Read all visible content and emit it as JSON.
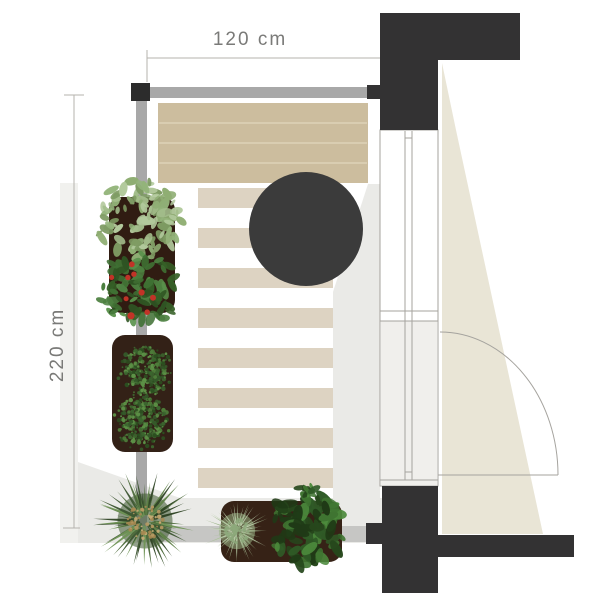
{
  "title": "Balcony floor plan, top view",
  "dimensions": {
    "width_label": "120 cm",
    "height_label": "220 cm"
  },
  "plan_items": [
    "wood-bench",
    "bistro-table",
    "striped-runner-rug",
    "balcony-railing",
    "tall-planter-with-leafy-herb",
    "tall-planter-with-strawberries",
    "planter-with-two-box-shrubs",
    "round-palm-plant",
    "trough-planter-with-fern-and-shrub",
    "glazed-balcony-door",
    "door-swing-arc",
    "wall-sections"
  ],
  "palette": {
    "wall": "#333233",
    "railing": "#a8a8a8",
    "railing_light": "#c6c6c4",
    "post": "#2c2c2c",
    "bench": "#ccbd9e",
    "bench_line": "#d9cdb1",
    "rug_base": "#ffffff",
    "rug_stripe": "#ddd3c2",
    "table": "#3b3b3b",
    "planter": "#33201575",
    "planter_solid": "#332015",
    "shade": "#eaeae7",
    "shade_soft": "#f1f1ee",
    "door_shade": "#e9e5d6",
    "line": "#b5b3ae",
    "frame_line": "#a5a39e",
    "door_lower": "#f0efec",
    "dim_text": "#7a7a78",
    "berry": "#c13327",
    "foliage": {
      "leafLight": [
        "#a3bd8b",
        "#8fae73",
        "#b2c99c",
        "#7d9a62",
        "#93b47a"
      ],
      "leafMid": [
        "#3f7033",
        "#4c8040",
        "#356027",
        "#58904a",
        "#2f5423"
      ],
      "leafDark": [
        "#3c662f",
        "#4e7d3a",
        "#2c4f20",
        "#5d9247",
        "#35592a"
      ],
      "leafDeep": [
        "#2f5a26",
        "#3f7431",
        "#26471c",
        "#4c8a3c",
        "#1f3a16"
      ],
      "palm": [
        "#4e6b3c",
        "#5f8148",
        "#3c5530",
        "#6f9355",
        "#2f4525"
      ],
      "palmCenter": [
        "#b89a63",
        "#a78a52",
        "#c9ad77"
      ],
      "fern": [
        "#a9bf97",
        "#b9cda8",
        "#98b184",
        "#c4d6b5"
      ],
      "fernCenter": [
        "#8da87b"
      ]
    }
  }
}
